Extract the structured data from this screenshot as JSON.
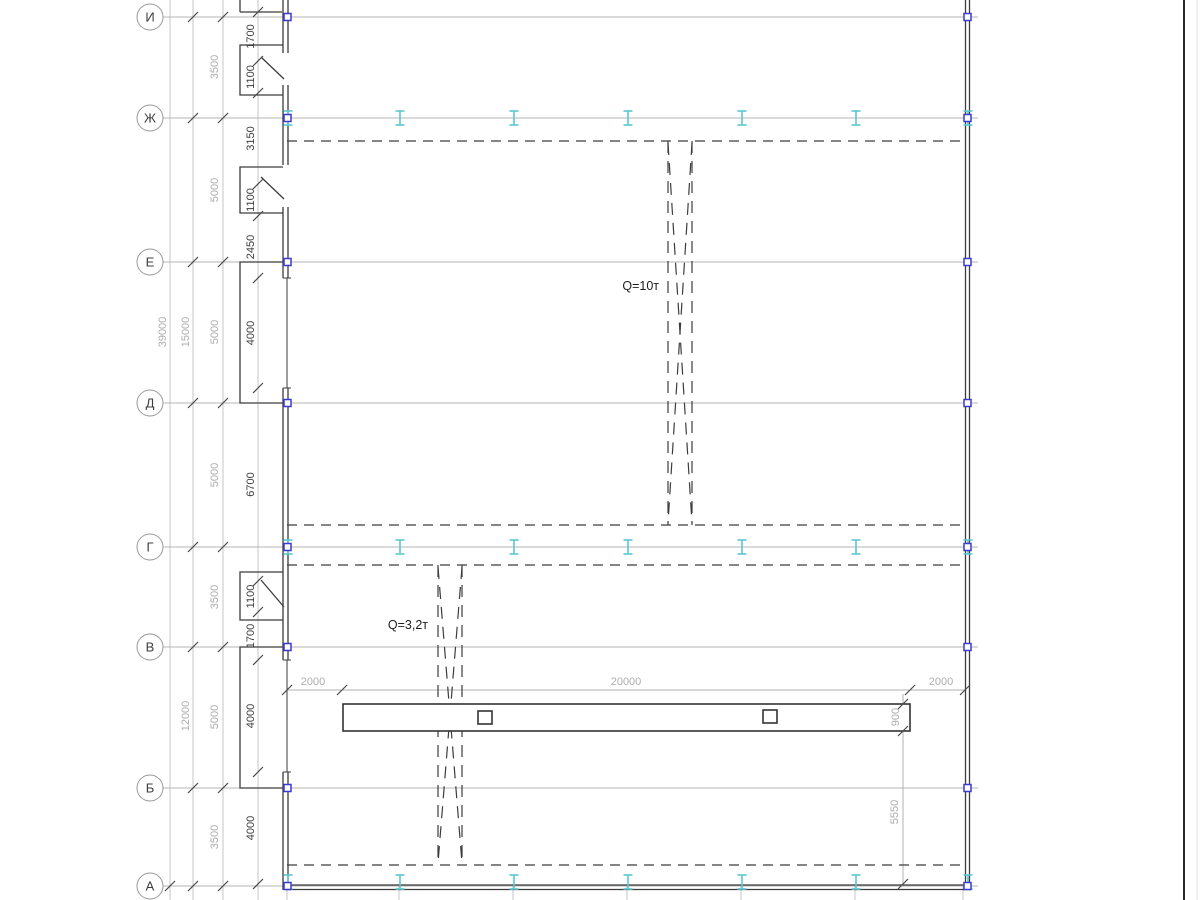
{
  "drawing": {
    "type": "structural-plan",
    "axes": [
      {
        "label": "И"
      },
      {
        "label": "Ж"
      },
      {
        "label": "Е"
      },
      {
        "label": "Д"
      },
      {
        "label": "Г"
      },
      {
        "label": "В"
      },
      {
        "label": "Б"
      },
      {
        "label": "А"
      }
    ],
    "dims": {
      "axis_spacing": [
        "3500",
        "5000",
        "5000",
        "5000",
        "3500",
        "5000",
        "3500"
      ],
      "group_totals": [
        "15000",
        "12000"
      ],
      "overall": [
        "39000"
      ],
      "wall_details": [
        "1700",
        "1100",
        "3150",
        "1100",
        "2450",
        "4000",
        "6700",
        "1100",
        "1700",
        "4000",
        "4000"
      ],
      "monorail_top": [
        "2000",
        "20000",
        "2000"
      ],
      "monorail_side": [
        "900",
        "5550"
      ]
    },
    "cranes": [
      {
        "label": "Q=10т"
      },
      {
        "label": "Q=3,2т"
      }
    ],
    "colors": {
      "grid_grey": "#c4c4c4",
      "axis_grey": "#b4b4b4",
      "dim_grey": "#b0b0b0",
      "dark_line": "#3c3c3c",
      "tick_dark": "#4a4a4a",
      "text_grey": "#adadad",
      "text_dark": "#3d3d3d",
      "crane_text": "#1f1f1f",
      "cyan_column": "#5cc6d0",
      "blue_marker": "#3b3bd0",
      "frame_dark": "#2b2b2b"
    }
  }
}
